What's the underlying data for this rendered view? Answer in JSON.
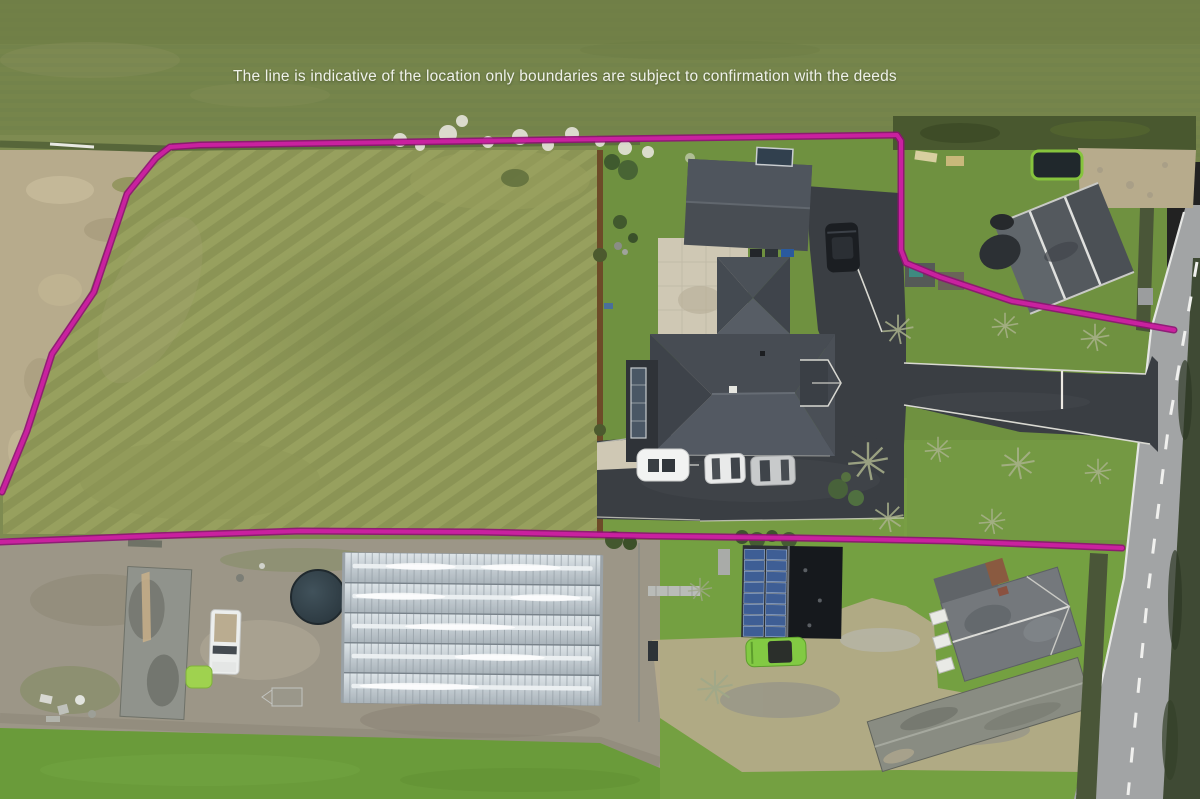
{
  "annotation": {
    "disclaimer": "The line is indicative of the location only boundaries are subject to confirmation with the deeds"
  },
  "colors": {
    "boundary": "#c9219f",
    "boundary-dark": "#8e1173",
    "field-green": "#76854b",
    "lawn-green": "#6f9140",
    "lawn-bright": "#74a041",
    "scrub-tan": "#b7ab8c",
    "dirt": "#9c9687",
    "asphalt": "#3a3e43",
    "road-gray": "#a2a4a5",
    "roof-slate": "#484d53",
    "patio-stone": "#cfc8b4",
    "greenhouse-glass": "#c3ccd1",
    "solar-blue": "#3e5e95",
    "grass-strip": "#6a9b3a",
    "text-white": "#eff1e9"
  }
}
